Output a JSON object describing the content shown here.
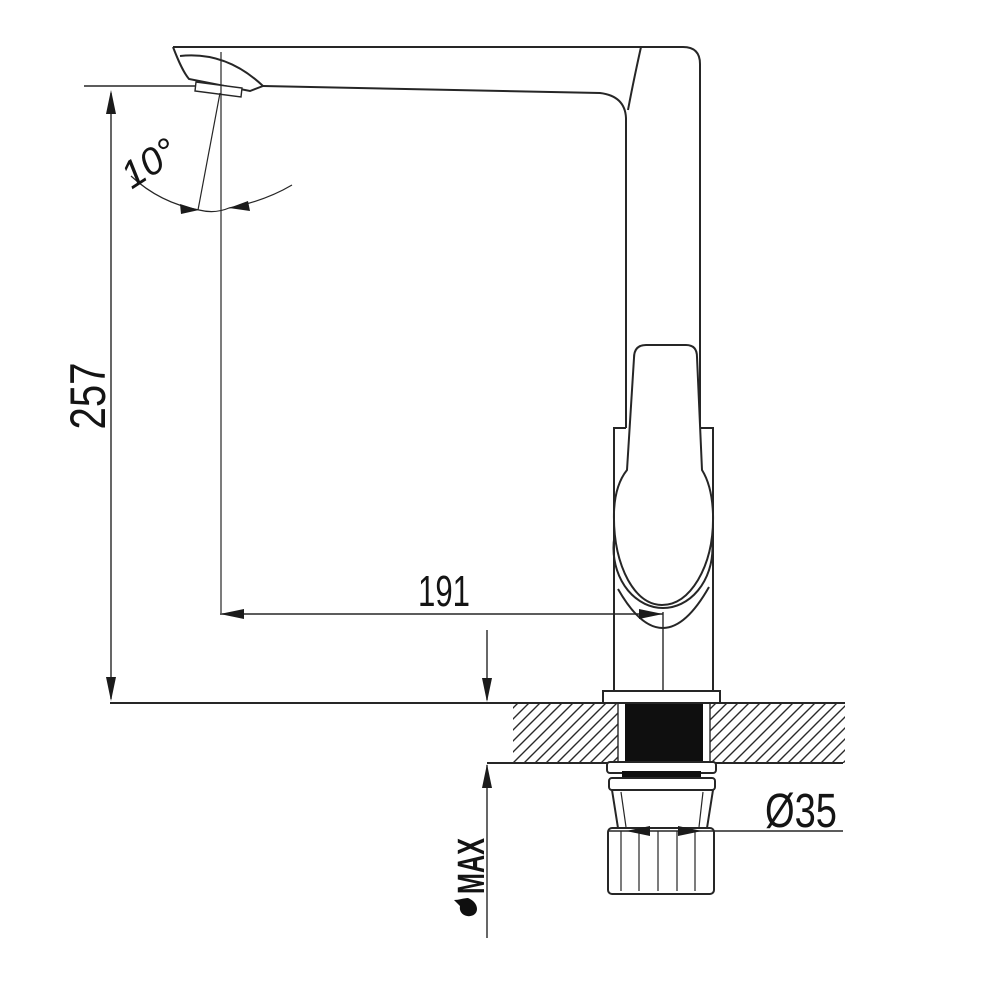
{
  "colors": {
    "background": "#ffffff",
    "line": "#262626",
    "solid_section": "#0f0f0f"
  },
  "labels": {
    "height_dim": "257",
    "reach_dim": "191",
    "angle_dim": "10°",
    "diameter_dim": "Ø35",
    "max_thickness": "MAX"
  }
}
